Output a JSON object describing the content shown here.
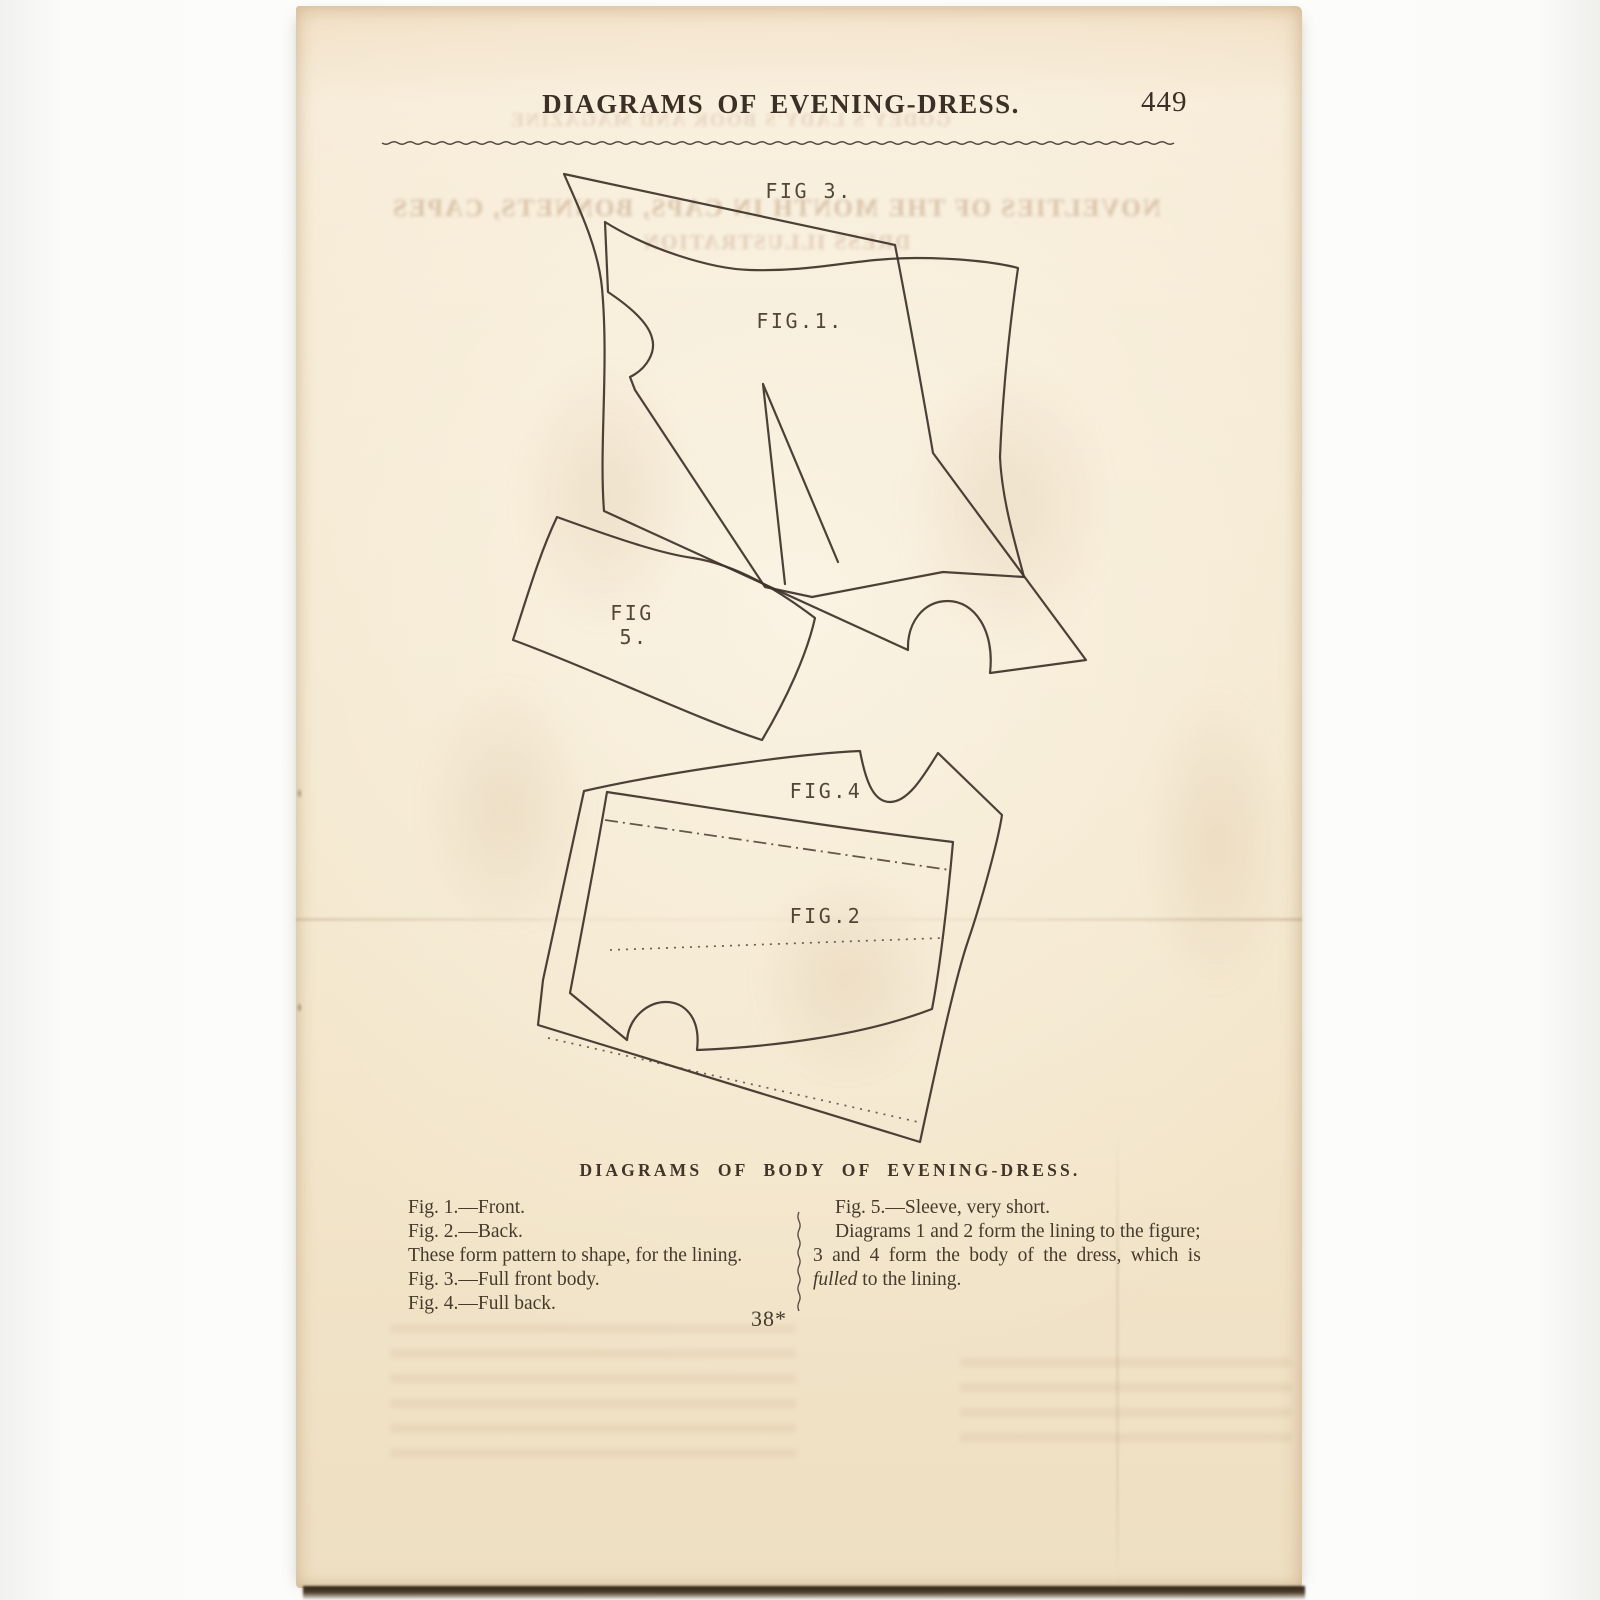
{
  "header": {
    "title": "DIAGRAMS OF EVENING-DRESS.",
    "page_number": "449"
  },
  "figure_labels": {
    "fig3": "FIG 3.",
    "fig1": "FIG.1.",
    "fig5_top": "FIG",
    "fig5_bottom": "5.",
    "fig4": "FIG.4",
    "fig2": "FIG.2"
  },
  "caption": "DIAGRAMS OF BODY OF EVENING-DRESS.",
  "signature_mark": "38*",
  "left_column": {
    "lines": [
      "Fig. 1.—Front.",
      "Fig. 2.—Back.",
      "These form pattern to shape, for the lining.",
      "Fig. 3.—Full front body.",
      "Fig. 4.—Full back."
    ]
  },
  "right_column": {
    "line1": "Fig. 5.—Sleeve, very short.",
    "line2": "Diagrams 1 and 2 form the lining to the figure;",
    "line3": "3 and 4 form the body of the dress, which is",
    "line4_italic": "fulled",
    "line4_rest": " to the lining."
  },
  "ghost_showthrough": {
    "title_echo": "GODEY'S LADY'S BOOK AND MAGAZINE",
    "line1": "NOVELTIES OF THE MONTH IN CAPS, BONNETS, CAPES",
    "line2": "DRESS ILLUSTRATION"
  },
  "colors": {
    "paper": "#f3e6cc",
    "ink": "#3e332a",
    "backdrop": "#fbfbf9",
    "bottom_shadow": "#2f2417"
  }
}
